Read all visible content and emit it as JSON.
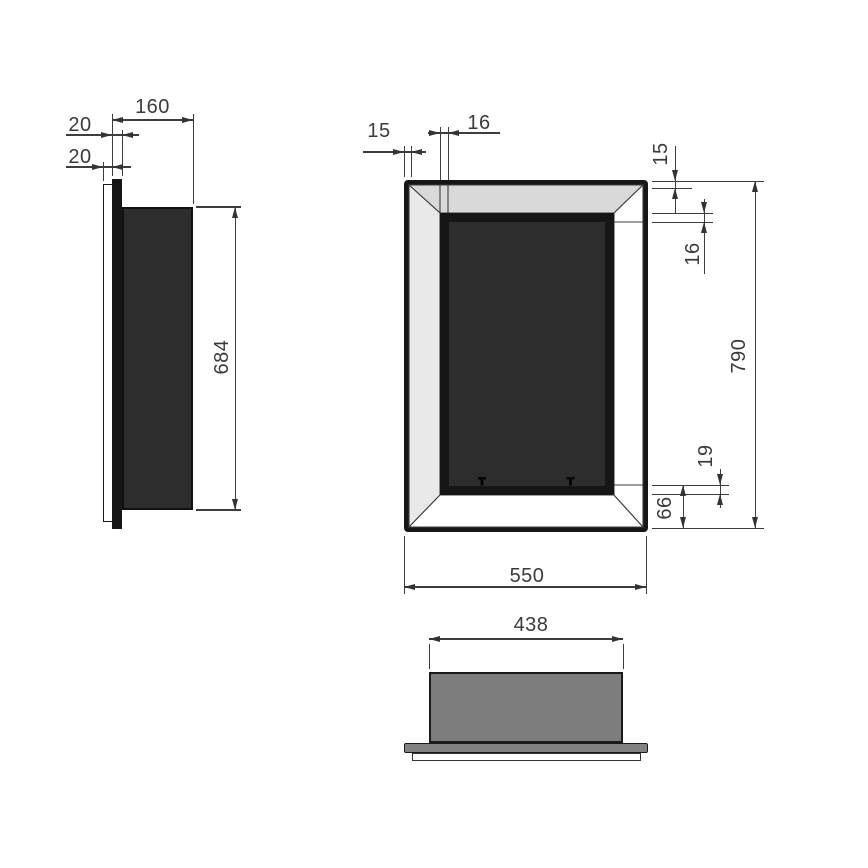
{
  "drawing": {
    "title": "wall-insert fireplace dimension drawing",
    "side_view": {
      "depth": "160",
      "flange_thickness": "20",
      "plate_thickness": "20",
      "body_height": "684"
    },
    "front_view": {
      "frame_side": "15",
      "lip_side": "16",
      "frame_top": "15",
      "lip_top": "16",
      "overall_height": "790",
      "lip_bottom": "19",
      "bottom_band": "66",
      "overall_width": "550"
    },
    "bottom_view": {
      "body_width": "438"
    },
    "colors": {
      "outline": "#161616",
      "part_dark": "#2d2d2d",
      "bevel_top": "#d9d9d9",
      "bevel_side": "#e9e9e9",
      "body_gray": "#7d7d7d",
      "dim_line": "#3d3d3d",
      "text": "#3a3a3a"
    }
  }
}
